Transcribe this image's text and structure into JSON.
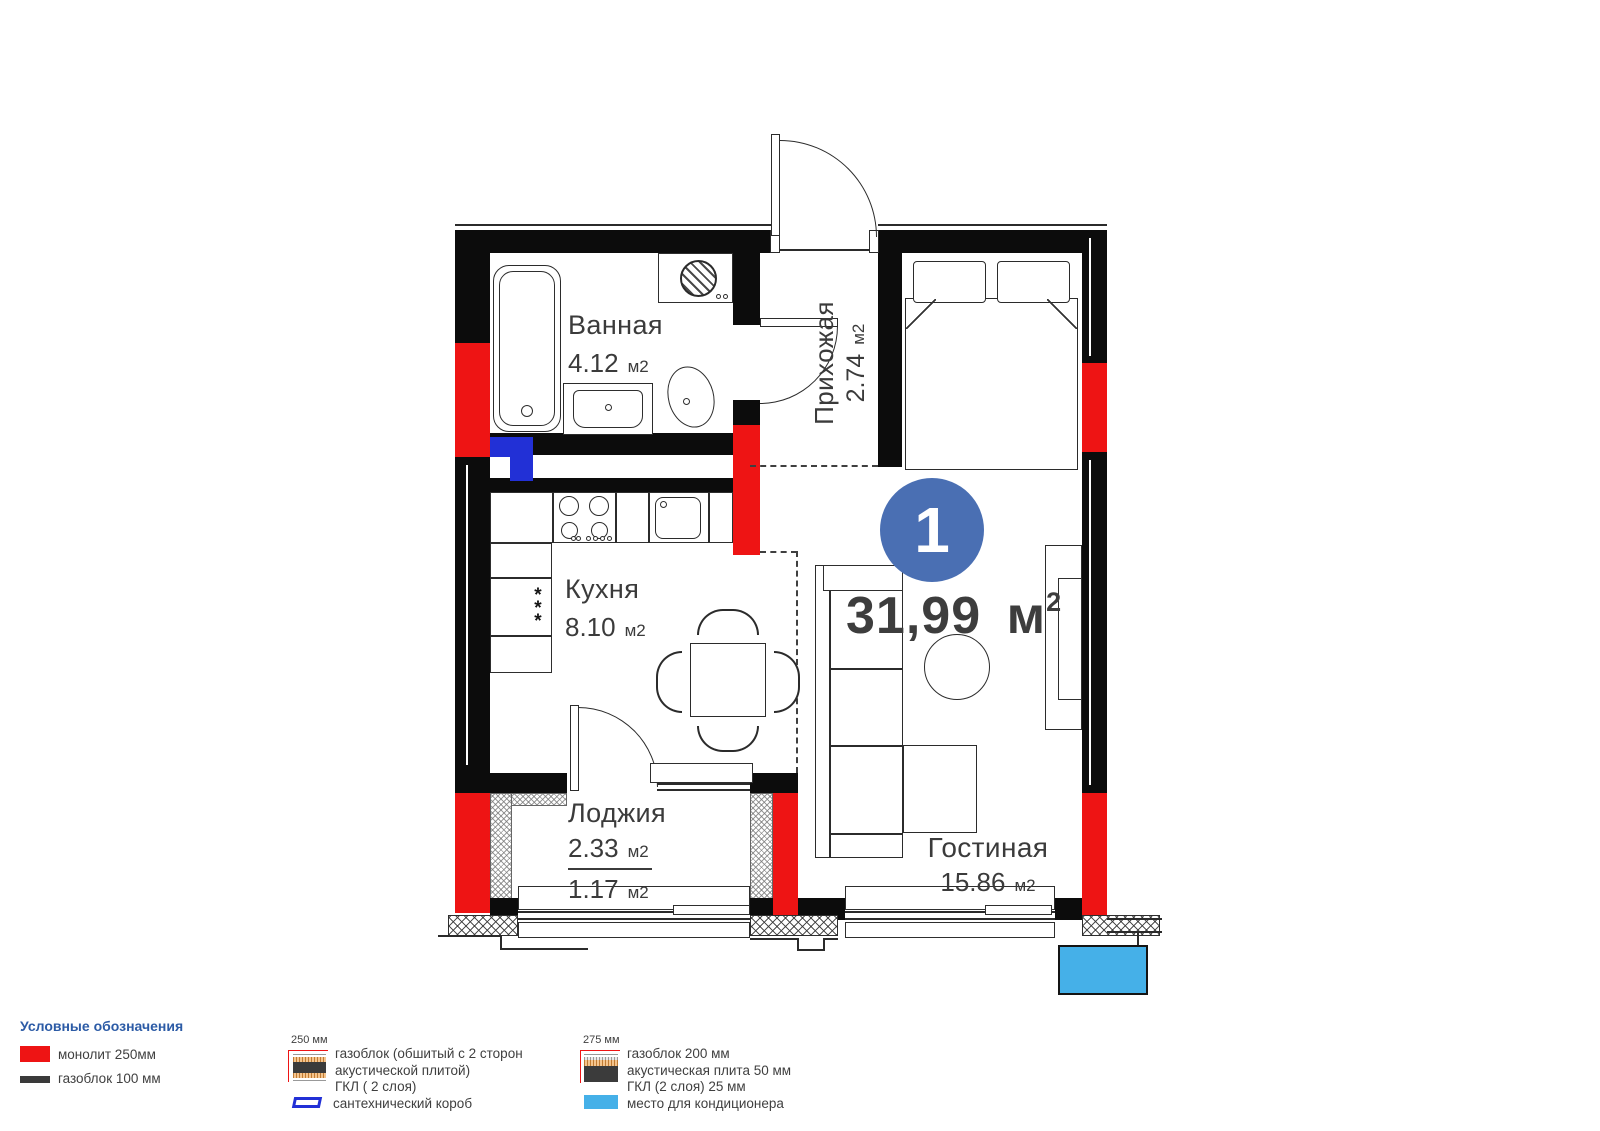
{
  "apartment": {
    "badge_number": "1",
    "total_area": "31,99",
    "total_unit": "м",
    "total_unit_sup": "2"
  },
  "rooms": {
    "bathroom": {
      "name": "Ванная",
      "area": "4.12",
      "unit": "м2"
    },
    "hallway": {
      "name": "Прихожая",
      "area": "2.74",
      "unit": "м2"
    },
    "kitchen": {
      "name": "Кухня",
      "area": "8.10",
      "unit": "м2"
    },
    "loggia": {
      "name": "Лоджия",
      "area_total": "2.33",
      "area_reduced": "1.17",
      "unit": "м2"
    },
    "living": {
      "name": "Гостиная",
      "area": "15.86",
      "unit": "м2"
    }
  },
  "icons": {
    "freezer_stars": "*\n*\n*"
  },
  "legend": {
    "title": "Условные обозначения",
    "monolith_label": "монолит 250мм",
    "gasblock_label": "газоблок 100 мм",
    "wall250": {
      "dim": "250 мм",
      "line1": "газоблок (обшитый с 2 сторон",
      "line2": "акустической плитой)",
      "line3": "ГКЛ ( 2 слоя)"
    },
    "plumbing_label": "сантехнический короб",
    "wall275": {
      "dim": "275 мм",
      "line1": "газоблок 200 мм",
      "line2": "акустическая плита 50 мм",
      "line3": "ГКЛ (2 слоя) 25 мм"
    },
    "ac_label": "место для кондиционера"
  },
  "colors": {
    "monolith_red": "#ee1414",
    "wall_black": "#0c0c0c",
    "plumbing_blue": "#2230d6",
    "badge_blue": "#4a6fb3",
    "ac_blue": "#45b0e8",
    "legend_title_blue": "#2c5ba6"
  }
}
